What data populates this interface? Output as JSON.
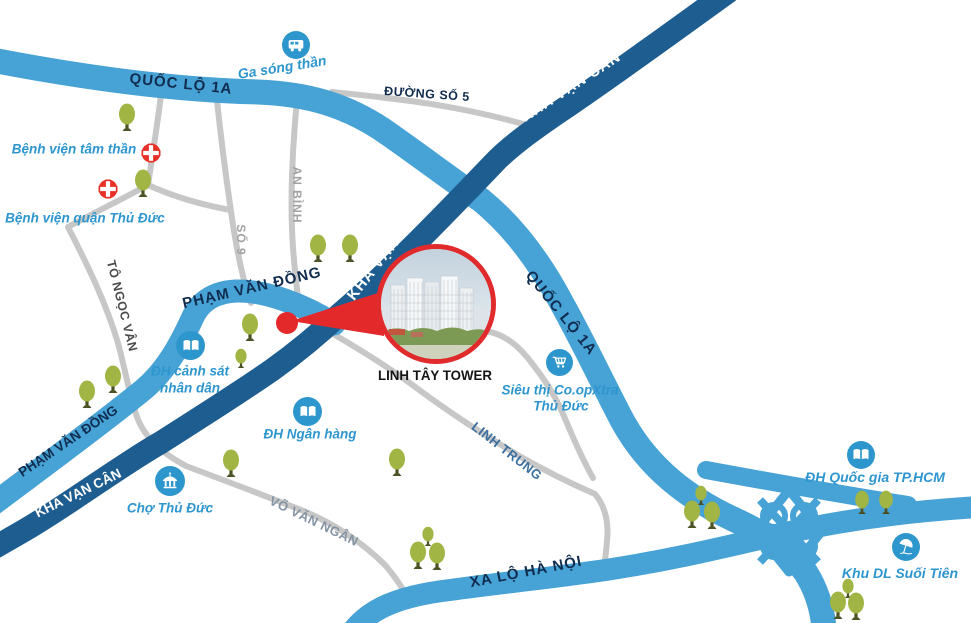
{
  "roads": {
    "quoc_lo_1a_nw": "QUỐC LỘ 1A",
    "quoc_lo_1a_east": "QUỐC LỘ 1A",
    "kha_van_can_north": "KHA VẠN CÂN",
    "kha_van_can_mid": "KHA VẠN CÂN",
    "kha_van_can_sw": "KHA VẠN CÂN",
    "pham_van_dong_mid": "PHẠM VĂN ĐỒNG",
    "pham_van_dong_sw": "PHẠM VĂN ĐỒNG",
    "xa_lo_ha_noi": "XA LỘ HÀ NỘI",
    "duong_so_5": "ĐƯỜNG SỐ 5",
    "an_binh": "AN BÌNH",
    "so_9": "SỐ 9",
    "to_ngoc_van": "TÔ NGỌC VÂN",
    "vo_van_ngan": "VÕ VĂN NGÂN",
    "linh_trung": "LINH TRUNG"
  },
  "landmarks": {
    "ga_song_than": {
      "label": "Ga sóng thần",
      "icon": "bus"
    },
    "benh_vien_tam_than": {
      "label": "Bệnh viện tâm thần",
      "icon": "red-cross"
    },
    "benh_vien_quan_thu_duc": {
      "label": "Bệnh viện quận Thủ Đức",
      "icon": "red-cross"
    },
    "dh_canh_sat": {
      "line1": "ĐH cảnh sát",
      "line2": "nhân dân",
      "icon": "book"
    },
    "dh_ngan_hang": {
      "label": "ĐH Ngân hàng",
      "icon": "book"
    },
    "dh_quoc_gia": {
      "label": "ĐH Quốc gia TP.HCM",
      "icon": "book"
    },
    "sieu_thi": {
      "line1": "Siêu thị Co.opXtra",
      "line2": "Thủ Đức",
      "icon": "cart"
    },
    "cho_thu_duc": {
      "label": "Chợ Thủ Đức",
      "icon": "market"
    },
    "khu_dl_suoi_tien": {
      "label": "Khu DL Suối Tiên",
      "icon": "umbrella"
    },
    "linh_tay_tower": {
      "label": "LINH TÂY TOWER",
      "icon": "photo-callout"
    }
  },
  "colors": {
    "road_light_blue": "#47a2d5",
    "road_dark_blue": "#1e5d90",
    "road_gray": "#c7c7c7",
    "landmark_blue": "#2d96cc",
    "accent_red": "#e4292b",
    "hospital_red": "#e63128",
    "tree_green": "#a1b544",
    "label_navy": "#102c4e"
  }
}
